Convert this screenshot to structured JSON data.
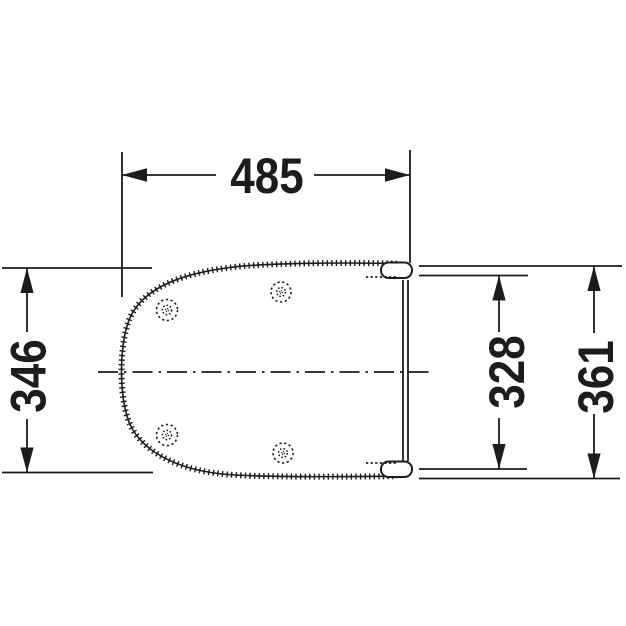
{
  "drawing": {
    "subject": "toilet-seat-top-view-dimension-drawing",
    "background_color": "#ffffff",
    "line_color": "#1c1c1c",
    "dimensions": {
      "overall_width": {
        "value": "485"
      },
      "left_height": {
        "value": "346"
      },
      "inner_right_height": {
        "value": "328"
      },
      "outer_right_height": {
        "value": "361"
      }
    }
  }
}
